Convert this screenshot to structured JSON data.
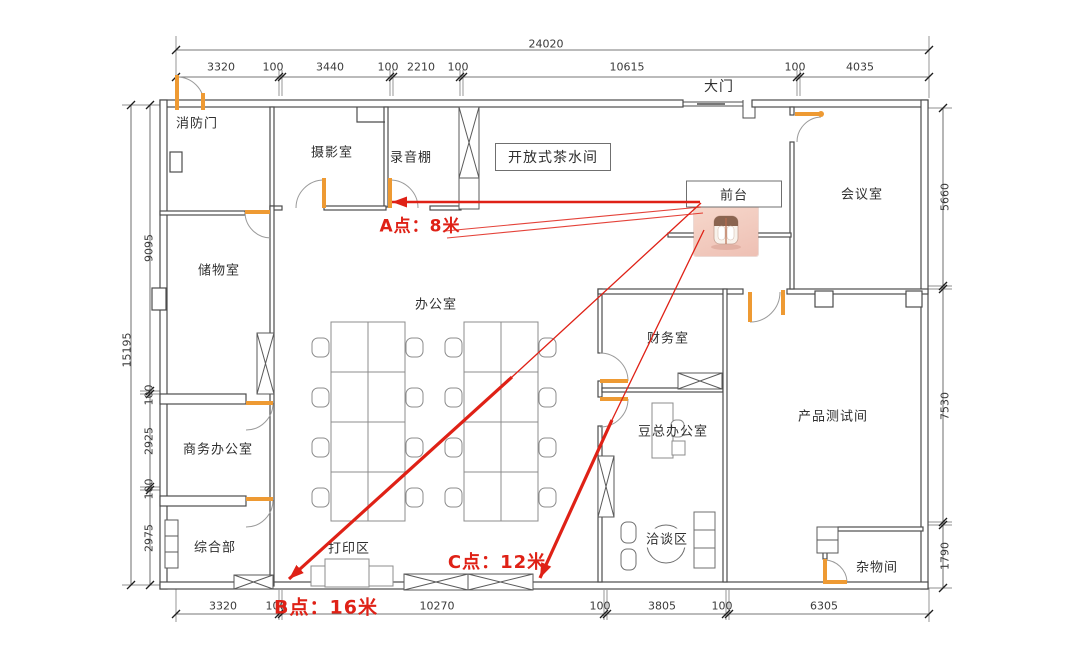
{
  "colors": {
    "red": "#df2116",
    "orange": "#ee9a33",
    "wall": "#4c4c4c",
    "furniture": "#8c8c8c",
    "dim_text": "#3a3a3a",
    "photo_pink": "#f3cdc2"
  },
  "rooms": {
    "fire_door": "消防门",
    "photography": "摄影室",
    "recording": "录音棚",
    "tea": "开放式茶水间",
    "gate": "大门",
    "reception": "前台",
    "meeting": "会议室",
    "storage": "储物室",
    "office": "办公室",
    "business": "商务办公室",
    "general": "综合部",
    "print": "打印区",
    "finance": "财务室",
    "boss": "豆总办公室",
    "product_test": "产品测试间",
    "negotiation": "洽谈区",
    "utility": "杂物间"
  },
  "annotations": {
    "point_a": "A点：8米",
    "point_b": "B点：16米",
    "point_c": "C点：12米"
  },
  "dims": {
    "overall_width": "24020",
    "overall_height": "15195",
    "top": [
      "3320",
      "100",
      "3440",
      "100",
      "2210",
      "100",
      "10615",
      "100",
      "4035"
    ],
    "bottom": [
      "3320",
      "100",
      "10270",
      "100",
      "3805",
      "100",
      "6305"
    ],
    "left": [
      "9095",
      "100",
      "2925",
      "100",
      "2975"
    ],
    "right": [
      "5660",
      "7530",
      "1790"
    ]
  }
}
